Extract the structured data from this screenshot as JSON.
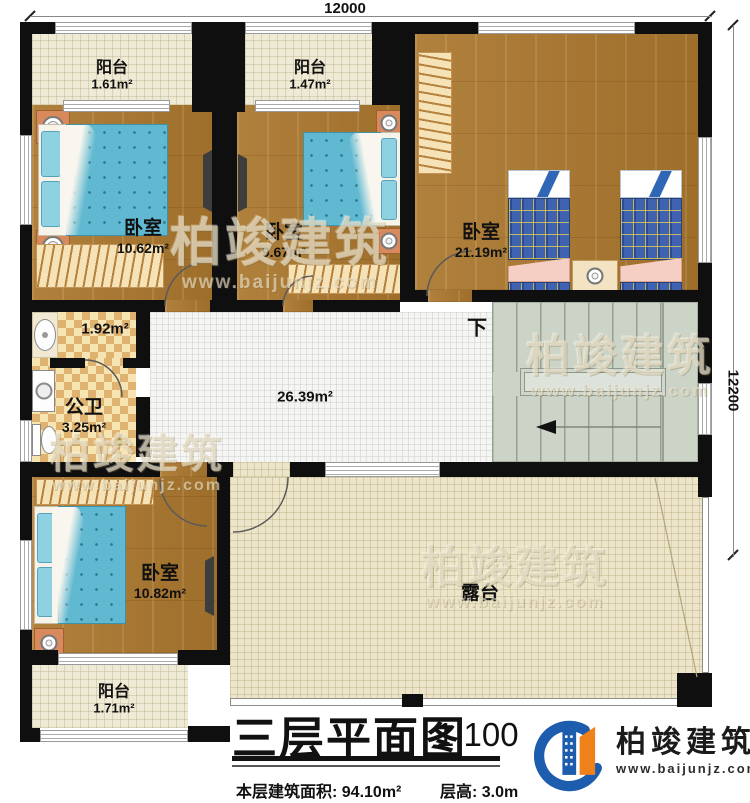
{
  "dimensions": {
    "width_label": "12000",
    "height_label": "12200"
  },
  "rooms": {
    "balcony_tl": {
      "name": "阳台",
      "area": "1.61m²"
    },
    "balcony_tm": {
      "name": "阳台",
      "area": "1.47m²"
    },
    "bedroom_tl": {
      "name": "卧室",
      "area": "10.62m²"
    },
    "bedroom_tm": {
      "name": "卧室",
      "area": "9.67m²"
    },
    "bedroom_tr": {
      "name": "卧室",
      "area": "21.19m²"
    },
    "bath_vanity": {
      "area": "1.92m²"
    },
    "bathroom": {
      "name": "公卫",
      "area": "3.25m²"
    },
    "hall": {
      "area": "26.39m²"
    },
    "stairs": {
      "down_label": "下"
    },
    "bedroom_bl": {
      "name": "卧室",
      "area": "10.82m²"
    },
    "balcony_bl": {
      "name": "阳台",
      "area": "1.71m²"
    },
    "terrace": {
      "name": "露台"
    }
  },
  "caption": {
    "title": "三层平面图",
    "scale": "1:100",
    "floor_area": "本层建筑面积: 94.10m²",
    "floor_height": "层高: 3.0m"
  },
  "brand": {
    "name": "柏竣建筑",
    "website": "www.baijunjz.com"
  }
}
